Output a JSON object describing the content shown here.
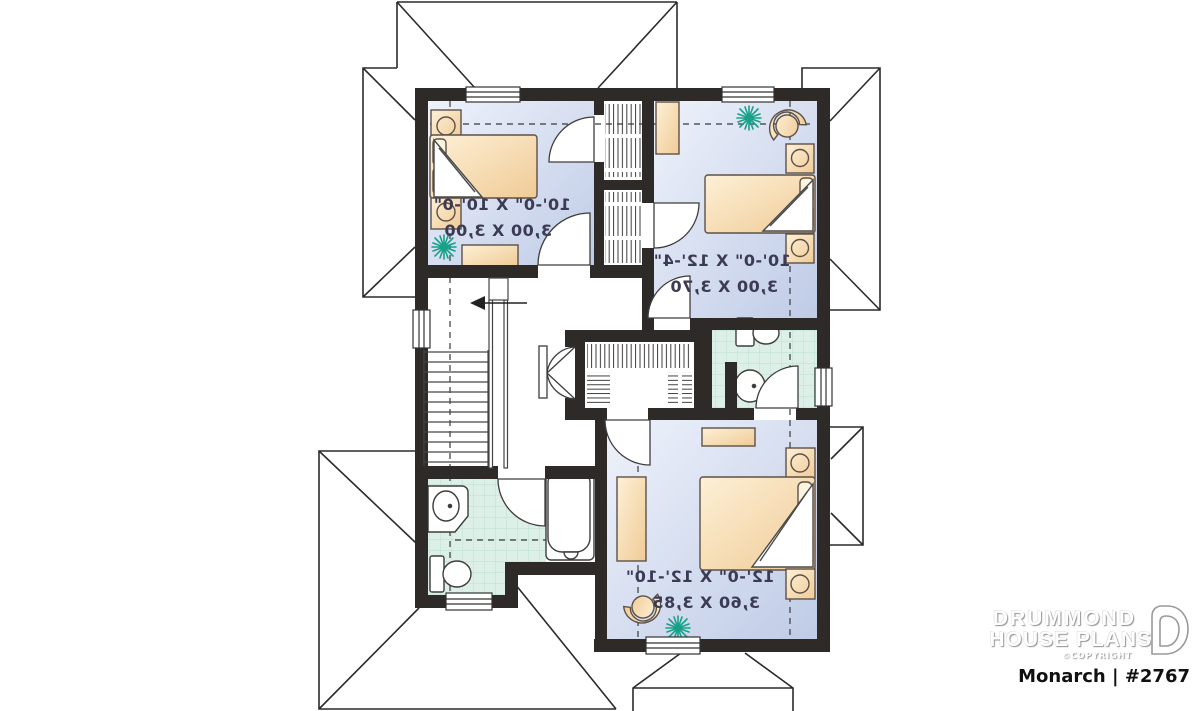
{
  "branding": {
    "name_line1": "DRUMMOND",
    "name_line2": "HOUSE PLANS",
    "copyright": "©COPYRIGHT",
    "plan_label": "Monarch | #2767"
  },
  "rooms": [
    {
      "name": "bedroom-1",
      "dim_imperial": "10'-0\" X 10'-0\"",
      "dim_metric": "3,00 X 3,00"
    },
    {
      "name": "bedroom-2",
      "dim_imperial": "10'-0\" X 12'-4\"",
      "dim_metric": "3,00 X 3,70"
    },
    {
      "name": "bedroom-3",
      "dim_imperial": "12'-0\" X 12'-10\"",
      "dim_metric": "3,60 X 3,85"
    }
  ],
  "plan": {
    "orientation": "mirrored-reverse-plan",
    "stairs_direction": "arrow-left",
    "features": [
      "stairs",
      "bathroom",
      "powder-room",
      "walk-in-closet",
      "3-bedrooms"
    ]
  },
  "colors": {
    "wall": "#2e2a28",
    "room_fill_light": "#eef2fb",
    "room_fill_dark": "#bfcbe6",
    "tile_fill": "#ddf0e8",
    "tile_grid": "#bce0d2",
    "furniture_light": "#fdf0d6",
    "furniture_dark": "#f0cb96",
    "plant_green": "#17a188",
    "label_text": "#3b3b55"
  },
  "icons": {
    "plant": "starburst",
    "stair_arrow": "arrow-left",
    "logo_mark": "drummond-d"
  }
}
